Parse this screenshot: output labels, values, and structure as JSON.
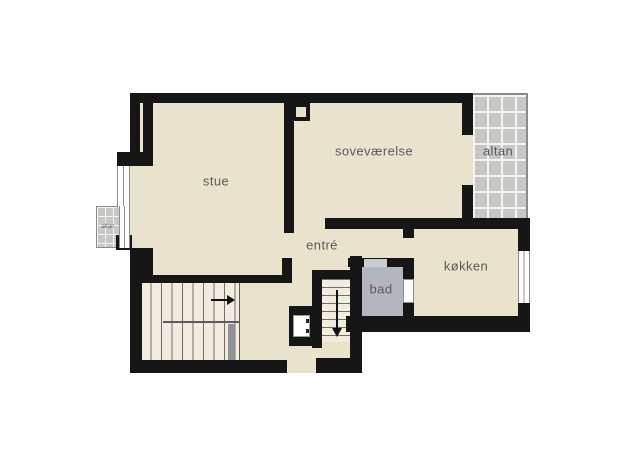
{
  "rooms": {
    "living_room": {
      "label": "stue"
    },
    "bedroom": {
      "label": "soveværelse"
    },
    "balcony_top": {
      "label": "altan"
    },
    "balcony_left": {
      "label": "altan"
    },
    "hall": {
      "label": "entré"
    },
    "kitchen": {
      "label": "køkken"
    },
    "bathroom": {
      "label": "bad"
    }
  },
  "colors": {
    "page": "#ffffff",
    "wall": "#161616",
    "room": "#e9e3ce",
    "stair": "#f1ecdd",
    "bath": "#b3b6bc",
    "balcony": "#c8c7c5",
    "balcony_line": "#f3f3f1",
    "outline": "#8a8a8a",
    "winline": "#8f8f8f",
    "rail": "#909296",
    "label": "#5b5b5b"
  }
}
